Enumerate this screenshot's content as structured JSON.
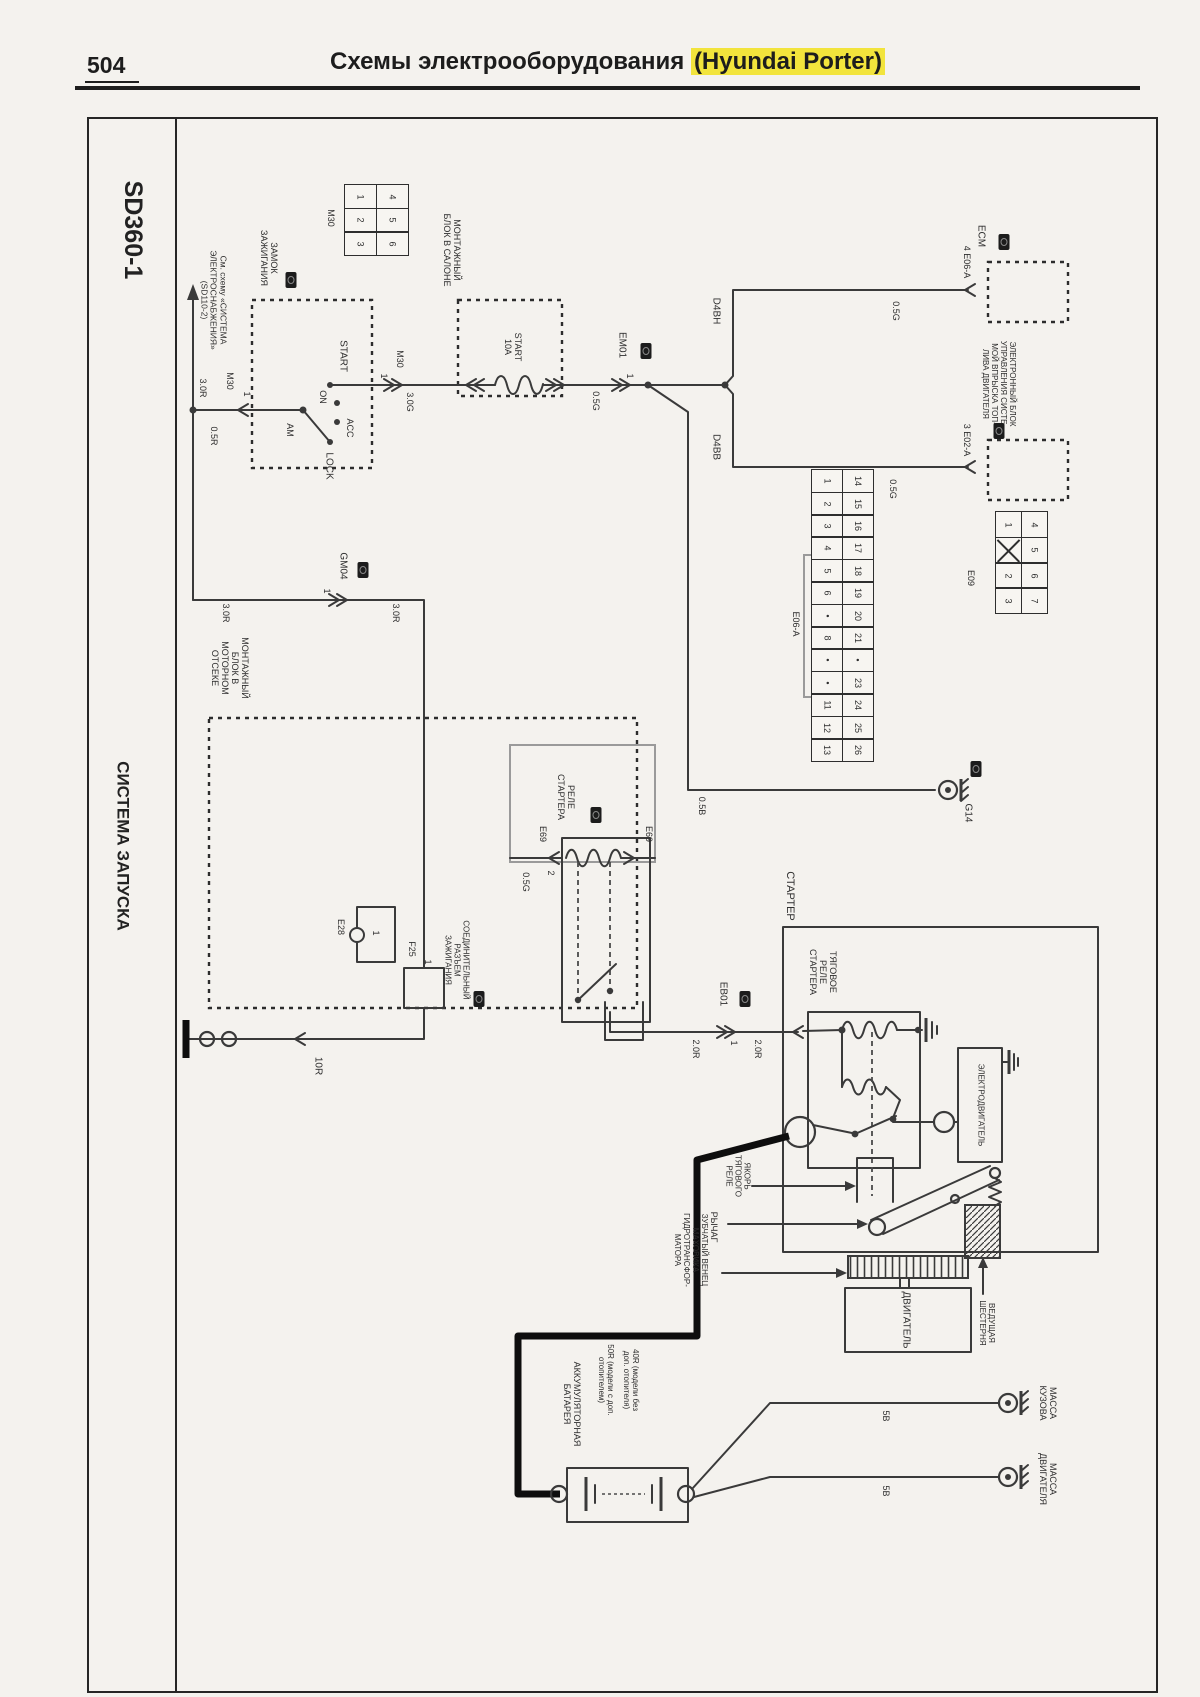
{
  "header": {
    "page_number": "504",
    "title_prefix": "Схемы электрооборудования ",
    "title_highlight": "(Hyundai Porter)",
    "highlight_color": "#f2e43c"
  },
  "sidebar": {
    "diagram_code": "SD360-1",
    "diagram_title": "СИСТЕМА ЗАПУСКА"
  },
  "diagram": {
    "labels": [
      {
        "name": "sidebar-code",
        "t": "SD360-1",
        "x": 133,
        "y": 230,
        "fs": 25,
        "b": 1
      },
      {
        "name": "sidebar-title",
        "t": "СИСТЕМА ЗАПУСКА",
        "x": 123,
        "y": 846,
        "fs": 17,
        "b": 1
      },
      {
        "name": "lbl-see-circuit",
        "t": "См. схему «СИСТЕМА|ЭЛЕКТРОСНАБЖЕНИЯ»|(SD110-2)",
        "x": 213,
        "y": 300,
        "fs": 8.5
      },
      {
        "name": "lbl-wire-30r-1",
        "t": "3.0R",
        "x": 203,
        "y": 388,
        "fs": 9
      },
      {
        "name": "lbl-wire-05r",
        "t": "0.5R",
        "x": 214,
        "y": 436,
        "fs": 9
      },
      {
        "name": "lbl-conn-m30-entry",
        "t": "M30",
        "x": 230,
        "y": 381,
        "fs": 9
      },
      {
        "name": "lbl-pin-m30-entry",
        "t": "1",
        "x": 247,
        "y": 394,
        "fs": 9
      },
      {
        "name": "lbl-ignition-lock",
        "t": "ЗАМОК|ЗАЖИГАНИЯ",
        "x": 269,
        "y": 258,
        "fs": 9
      },
      {
        "name": "lbl-start",
        "t": "START",
        "x": 343,
        "y": 356,
        "fs": 10
      },
      {
        "name": "lbl-on",
        "t": "ON",
        "x": 323,
        "y": 397,
        "fs": 9
      },
      {
        "name": "lbl-acc",
        "t": "ACC",
        "x": 350,
        "y": 428,
        "fs": 9
      },
      {
        "name": "lbl-am",
        "t": "AM",
        "x": 290,
        "y": 430,
        "fs": 9
      },
      {
        "name": "lbl-lock",
        "t": "LOCK",
        "x": 329,
        "y": 466,
        "fs": 10
      },
      {
        "name": "lbl-pin-m30-exit",
        "t": "1",
        "x": 384,
        "y": 376,
        "fs": 9
      },
      {
        "name": "lbl-conn-m30-exit",
        "t": "M30",
        "x": 400,
        "y": 359,
        "fs": 9
      },
      {
        "name": "lbl-wire-30g",
        "t": "3.0G",
        "x": 410,
        "y": 402,
        "fs": 9
      },
      {
        "name": "lbl-cabin-box",
        "t": "МОНТАЖНЫЙ|БЛОК В САЛОНЕ",
        "x": 452,
        "y": 250,
        "fs": 9
      },
      {
        "name": "lbl-fuse-start",
        "t": "START|10A",
        "x": 513,
        "y": 347,
        "fs": 9
      },
      {
        "name": "lbl-wire-05g-1",
        "t": "0.5G",
        "x": 596,
        "y": 401,
        "fs": 9
      },
      {
        "name": "lbl-pin-em01",
        "t": "1",
        "x": 630,
        "y": 376,
        "fs": 9
      },
      {
        "name": "lbl-conn-em01",
        "t": "EM01",
        "x": 622,
        "y": 345,
        "fs": 10
      },
      {
        "name": "lbl-d4bh",
        "t": "D4BH",
        "x": 716,
        "y": 311,
        "fs": 10
      },
      {
        "name": "lbl-wire-05g-2",
        "t": "0.5G",
        "x": 896,
        "y": 311,
        "fs": 9
      },
      {
        "name": "lbl-pin-e06a",
        "t": "4  E06-A",
        "x": 967,
        "y": 262,
        "fs": 9
      },
      {
        "name": "lbl-ecm",
        "t": "ECM",
        "x": 981,
        "y": 236,
        "fs": 10
      },
      {
        "name": "lbl-d4bb",
        "t": "D4BB",
        "x": 716,
        "y": 447,
        "fs": 10
      },
      {
        "name": "lbl-wire-05g-3",
        "t": "0.5G",
        "x": 893,
        "y": 489,
        "fs": 9
      },
      {
        "name": "lbl-pin-e02a",
        "t": "3  E02-A",
        "x": 967,
        "y": 440,
        "fs": 9
      },
      {
        "name": "lbl-ecu-diesel",
        "t": "ЭЛЕКТРОННЫЙ БЛОК|УПРАВЛЕНИЯ СИСТЕ-|МОЙ ВПРЫСКА ТОП-|ЛИВА ДВИГАТЕЛЯ",
        "x": 998,
        "y": 384,
        "fs": 8
      },
      {
        "name": "lbl-wire-30r-2",
        "t": "3.0R",
        "x": 226,
        "y": 613,
        "fs": 9
      },
      {
        "name": "lbl-pin-gm04",
        "t": "1",
        "x": 327,
        "y": 591,
        "fs": 9
      },
      {
        "name": "lbl-conn-gm04",
        "t": "GM04",
        "x": 343,
        "y": 566,
        "fs": 10
      },
      {
        "name": "lbl-wire-30r-3",
        "t": "3.0R",
        "x": 396,
        "y": 613,
        "fs": 9
      },
      {
        "name": "lbl-engine-bay-box",
        "t": "МОНТАЖНЫЙ|БЛОК В|МОТОРНОМ|ОТСЕКЕ",
        "x": 230,
        "y": 668,
        "fs": 9
      },
      {
        "name": "lbl-conn-m30-grid",
        "t": "M30",
        "x": 331,
        "y": 218,
        "fs": 9
      },
      {
        "name": "lbl-e28",
        "t": "Е28",
        "x": 341,
        "y": 927,
        "fs": 9
      },
      {
        "name": "lbl-e28-pin",
        "t": "1",
        "x": 376,
        "y": 933,
        "fs": 9
      },
      {
        "name": "lbl-f25",
        "t": "F25",
        "x": 412,
        "y": 949,
        "fs": 9
      },
      {
        "name": "lbl-f25-pin",
        "t": "1",
        "x": 428,
        "y": 962,
        "fs": 9
      },
      {
        "name": "lbl-starter-relay",
        "t": "РЕЛЕ|СТАРТЕРА",
        "x": 566,
        "y": 797,
        "fs": 9
      },
      {
        "name": "lbl-e69-left",
        "t": "Е69",
        "x": 543,
        "y": 834,
        "fs": 9
      },
      {
        "name": "lbl-e69-pin2",
        "t": "2",
        "x": 551,
        "y": 873,
        "fs": 9
      },
      {
        "name": "lbl-e69-right",
        "t": "Е69",
        "x": 649,
        "y": 834,
        "fs": 9
      },
      {
        "name": "lbl-wire-05g-4",
        "t": "0.5G",
        "x": 526,
        "y": 882,
        "fs": 9
      },
      {
        "name": "lbl-ignition-joint",
        "t": "СОЕДИНИТЕЛЬНЫЙ|РАЗЪЕМ|ЗАЖИГАНИЯ",
        "x": 456,
        "y": 960,
        "fs": 8
      },
      {
        "name": "lbl-wire-10r",
        "t": "10R",
        "x": 318,
        "y": 1066,
        "fs": 10
      },
      {
        "name": "lbl-wire-20r-1",
        "t": "2.0R",
        "x": 696,
        "y": 1049,
        "fs": 9
      },
      {
        "name": "lbl-pin-eb01",
        "t": "1",
        "x": 734,
        "y": 1043,
        "fs": 9
      },
      {
        "name": "lbl-conn-eb01",
        "t": "ЕВ01",
        "x": 723,
        "y": 994,
        "fs": 10
      },
      {
        "name": "lbl-wire-20r-2",
        "t": "2.0R",
        "x": 758,
        "y": 1049,
        "fs": 9
      },
      {
        "name": "lbl-starter",
        "t": "СТАРТЕР",
        "x": 790,
        "y": 896,
        "fs": 11
      },
      {
        "name": "lbl-solenoid",
        "t": "ТЯГОВОЕ|РЕЛЕ|СТАРТЕРА",
        "x": 823,
        "y": 972,
        "fs": 9
      },
      {
        "name": "lbl-motor",
        "t": "ЭЛЕКТРОДВИГАТЕЛЬ",
        "x": 980,
        "y": 1105,
        "fs": 8
      },
      {
        "name": "lbl-armature",
        "t": "ЯКОРЬ|ТЯГОВОГО|РЕЛЕ",
        "x": 737,
        "y": 1176,
        "fs": 8
      },
      {
        "name": "lbl-lever",
        "t": "РЫЧАГ",
        "x": 714,
        "y": 1227,
        "fs": 9
      },
      {
        "name": "lbl-gear-ring",
        "t": "ЗУБЧАТЫЙ ВЕНЕЦ|МАХОВИКА|ГИДРОТРАНСФОР-|МАТОРА",
        "x": 690,
        "y": 1250,
        "fs": 8
      },
      {
        "name": "lbl-pinion",
        "t": "ВЕДУЩАЯ|ШЕСТЕРНЯ",
        "x": 986,
        "y": 1323,
        "fs": 8
      },
      {
        "name": "lbl-engine",
        "t": "ДВИГАТЕЛЬ",
        "x": 906,
        "y": 1320,
        "fs": 10
      },
      {
        "name": "lbl-battery",
        "t": "АККУМУЛЯТОРНАЯ|БАТАРЕЯ",
        "x": 572,
        "y": 1404,
        "fs": 9
      },
      {
        "name": "lbl-battery-note1",
        "t": "50R (модели с доп.|отопителем)",
        "x": 605,
        "y": 1380,
        "fs": 8
      },
      {
        "name": "lbl-battery-note2",
        "t": "40R (модели без|доп. отопителя)",
        "x": 630,
        "y": 1380,
        "fs": 8
      },
      {
        "name": "lbl-wire-5b-1",
        "t": "5B",
        "x": 886,
        "y": 1416,
        "fs": 9
      },
      {
        "name": "lbl-wire-5b-2",
        "t": "5B",
        "x": 886,
        "y": 1491,
        "fs": 9
      },
      {
        "name": "lbl-ground-body",
        "t": "МАССА|КУЗОВА",
        "x": 1048,
        "y": 1403,
        "fs": 9
      },
      {
        "name": "lbl-ground-engine",
        "t": "МАССА|ДВИГАТЕЛЯ",
        "x": 1048,
        "y": 1479,
        "fs": 9
      },
      {
        "name": "lbl-g14",
        "t": "G14",
        "x": 968,
        "y": 813,
        "fs": 10
      },
      {
        "name": "lbl-wire-05b",
        "t": "0.5B",
        "x": 702,
        "y": 806,
        "fs": 9
      },
      {
        "name": "lbl-e06a-bracket",
        "t": "Е06-А",
        "x": 796,
        "y": 624,
        "fs": 9
      },
      {
        "name": "lbl-e09",
        "t": "Е09",
        "x": 971,
        "y": 578,
        "fs": 9
      }
    ],
    "grids": [
      {
        "name": "connector-m30",
        "x": 345,
        "y": 185,
        "cell_w": 33,
        "cell_h": 25,
        "cols": [
          [
            "1",
            "2",
            "3"
          ],
          [
            "4",
            "5",
            "6"
          ]
        ]
      },
      {
        "name": "connector-e06a",
        "x": 812,
        "y": 470,
        "cell_w": 32,
        "cell_h": 24,
        "cols": [
          [
            "1",
            "2",
            "3",
            "4",
            "5",
            "6",
            "•",
            "8",
            "•",
            "•",
            "11",
            "12",
            "13"
          ],
          [
            "14",
            "15",
            "16",
            "17",
            "18",
            "19",
            "20",
            "21",
            "•",
            "23",
            "24",
            "25",
            "26"
          ]
        ]
      },
      {
        "name": "connector-e09",
        "x": 996,
        "y": 512,
        "cell_w": 27,
        "cell_h": 27,
        "cols": [
          [
            "1",
            "X",
            "2",
            "3"
          ],
          [
            "4",
            "5",
            "6",
            "7"
          ]
        ]
      }
    ],
    "camera_icons": [
      {
        "x": 291,
        "y": 280
      },
      {
        "x": 646,
        "y": 351
      },
      {
        "x": 363,
        "y": 570
      },
      {
        "x": 1004,
        "y": 242
      },
      {
        "x": 999,
        "y": 431
      },
      {
        "x": 976,
        "y": 769
      },
      {
        "x": 596,
        "y": 815
      },
      {
        "x": 479,
        "y": 999
      },
      {
        "x": 745,
        "y": 999
      }
    ]
  }
}
